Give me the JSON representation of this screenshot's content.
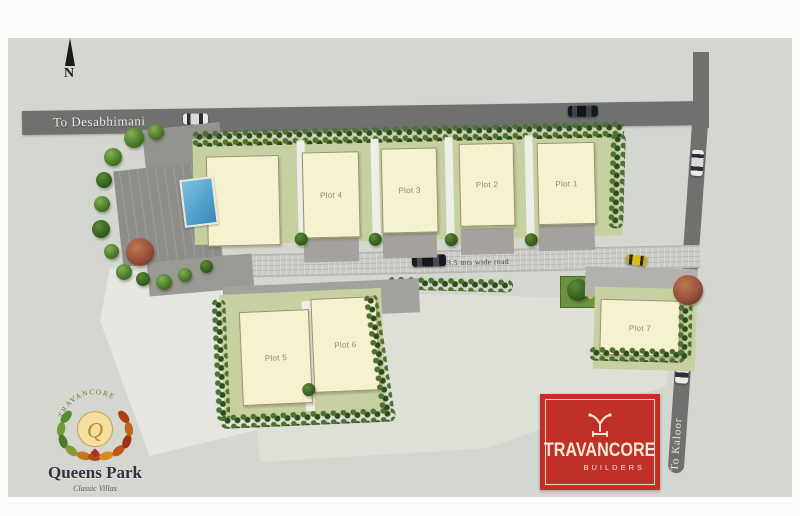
{
  "compass": {
    "label": "N"
  },
  "roads": {
    "top": {
      "label": "To Desabhimani"
    },
    "right": {
      "label": "To Kaloor"
    },
    "central": {
      "label": "3.5 mts wide road"
    }
  },
  "plots": [
    {
      "label": "Plot 1"
    },
    {
      "label": "Plot 2"
    },
    {
      "label": "Plot 3"
    },
    {
      "label": "Plot 4"
    },
    {
      "label": "Plot 5"
    },
    {
      "label": "Plot 6"
    },
    {
      "label": "Plot 7"
    }
  ],
  "logos": {
    "queens_park": {
      "arc_text": "TRAVANCORE",
      "monogram": "Q",
      "title": "Queens Park",
      "subtitle": "Classic Villas"
    },
    "builder": {
      "title": "TRAVANCORE",
      "subtitle": "BUILDERS"
    }
  },
  "colors": {
    "map_background": "#d3d7cf",
    "road_dark": "#6e716e",
    "central_road": "#cbccc6",
    "plot_fill": "#f6f1cf",
    "yard_green": "#c6d0a0",
    "hedge_green": "#4e7030",
    "pool_blue": "#4f9fcb",
    "parking_gray": "#8e8d89",
    "builder_red": "#c13028"
  }
}
